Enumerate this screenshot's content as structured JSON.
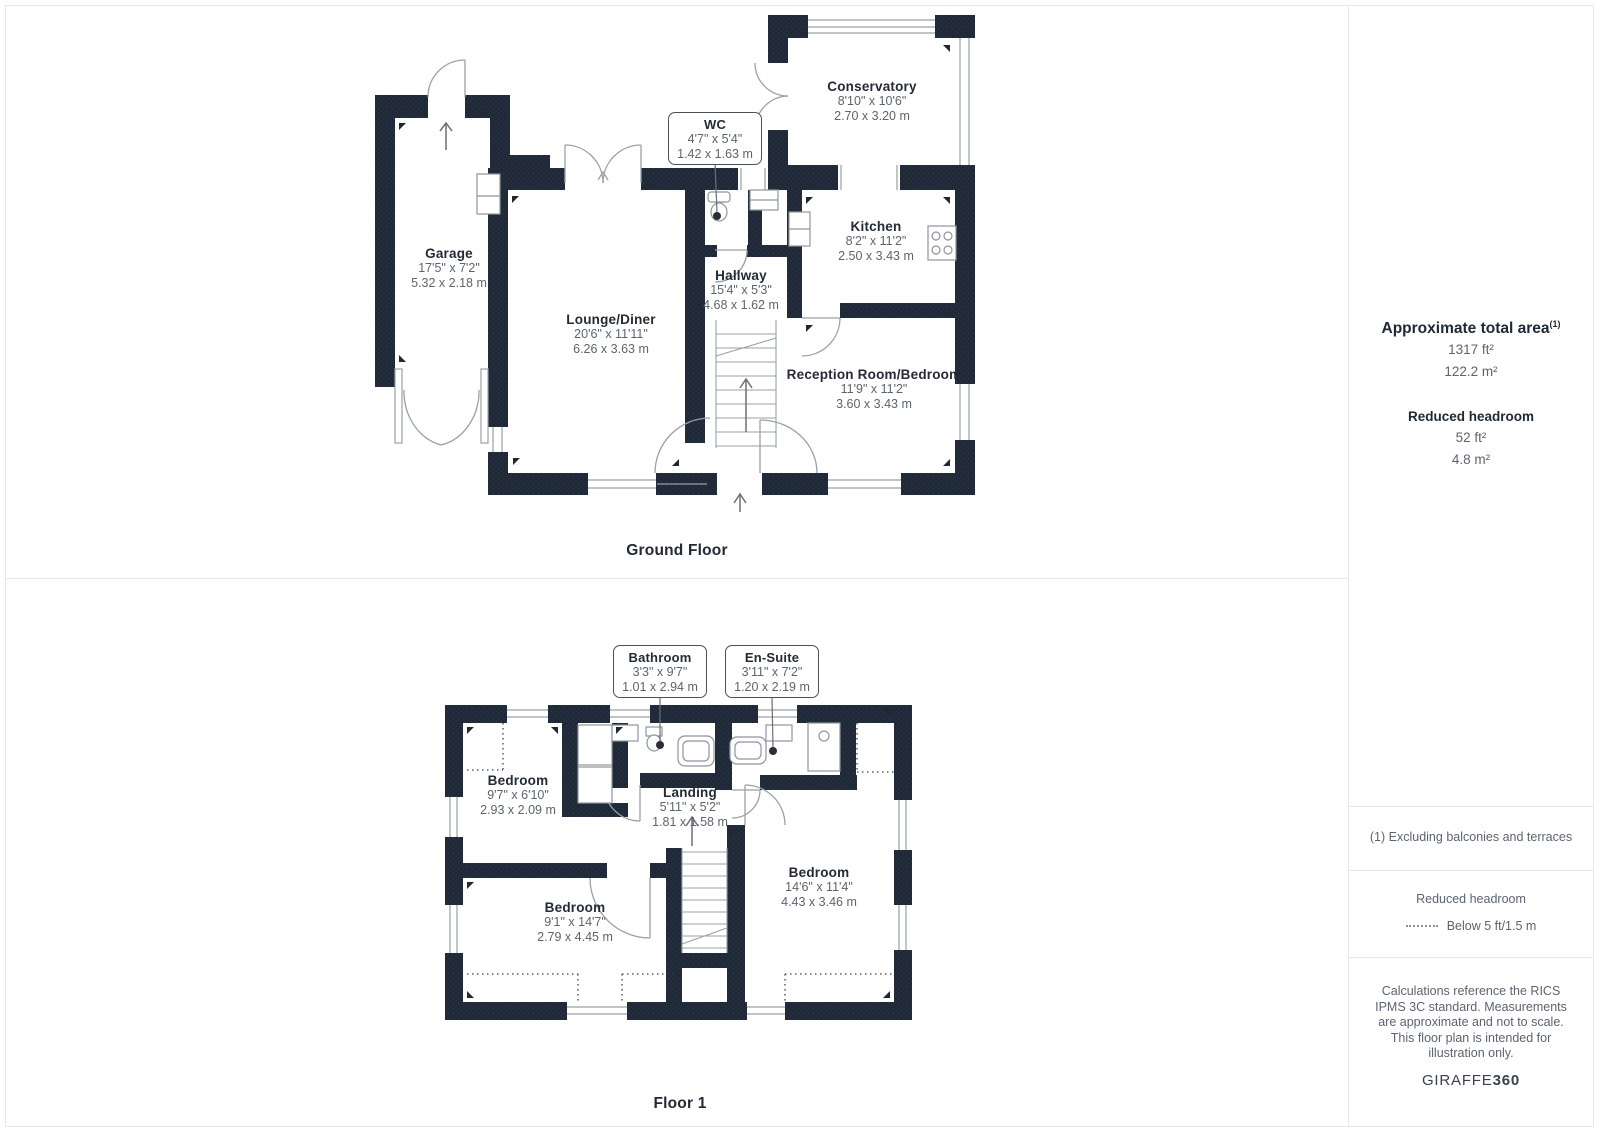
{
  "ground_floor": {
    "caption": "Ground Floor",
    "rooms": {
      "garage": {
        "name": "Garage",
        "dims_ft": "17'5\" x 7'2\"",
        "dims_m": "5.32 x 2.18 m"
      },
      "lounge_diner": {
        "name": "Lounge/Diner",
        "dims_ft": "20'6\" x 11'11\"",
        "dims_m": "6.26 x 3.63 m"
      },
      "wc": {
        "name": "WC",
        "dims_ft": "4'7\" x 5'4\"",
        "dims_m": "1.42 x 1.63 m"
      },
      "conservatory": {
        "name": "Conservatory",
        "dims_ft": "8'10\" x 10'6\"",
        "dims_m": "2.70 x 3.20 m"
      },
      "kitchen": {
        "name": "Kitchen",
        "dims_ft": "8'2\" x 11'2\"",
        "dims_m": "2.50 x 3.43 m"
      },
      "hallway": {
        "name": "Hallway",
        "dims_ft": "15'4\" x 5'3\"",
        "dims_m": "4.68 x 1.62 m"
      },
      "reception": {
        "name": "Reception Room/Bedroom",
        "dims_ft": "11'9\" x 11'2\"",
        "dims_m": "3.60 x 3.43 m"
      }
    }
  },
  "floor_1": {
    "caption": "Floor 1",
    "rooms": {
      "bathroom": {
        "name": "Bathroom",
        "dims_ft": "3'3\" x 9'7\"",
        "dims_m": "1.01 x 2.94 m"
      },
      "en_suite": {
        "name": "En-Suite",
        "dims_ft": "3'11\" x 7'2\"",
        "dims_m": "1.20 x 2.19 m"
      },
      "bedroom_1": {
        "name": "Bedroom",
        "dims_ft": "9'7\" x 6'10\"",
        "dims_m": "2.93 x 2.09 m"
      },
      "landing": {
        "name": "Landing",
        "dims_ft": "5'11\" x 5'2\"",
        "dims_m": "1.81 x 1.58 m"
      },
      "bedroom_2": {
        "name": "Bedroom",
        "dims_ft": "14'6\" x 11'4\"",
        "dims_m": "4.43 x 3.46 m"
      },
      "bedroom_3": {
        "name": "Bedroom",
        "dims_ft": "9'1\" x 14'7\"",
        "dims_m": "2.79 x 4.45 m"
      }
    }
  },
  "sidebar": {
    "total_area": {
      "title": "Approximate total area",
      "footnote_marker": "(1)",
      "value_ft": "1317 ft²",
      "value_m": "122.2 m²"
    },
    "reduced_headroom": {
      "title": "Reduced headroom",
      "value_ft": "52 ft²",
      "value_m": "4.8 m²"
    },
    "footnote": "(1) Excluding balconies and terraces",
    "legend": {
      "title": "Reduced headroom",
      "label": "Below 5 ft/1.5 m"
    },
    "disclaimer": "Calculations reference the RICS IPMS 3C standard. Measurements are approximate and not to scale. This floor plan is intended for illustration only.",
    "brand": {
      "name": "GIRAFFE",
      "suffix": "360"
    }
  },
  "colors": {
    "wall": "#1f2937",
    "wall_dot": "#2d3847",
    "line": "#9aa0a8",
    "text_dark": "#242b35",
    "text_gray": "#5d646e",
    "divider": "#e6e8ea",
    "dot_marker": "#2a2f36"
  }
}
